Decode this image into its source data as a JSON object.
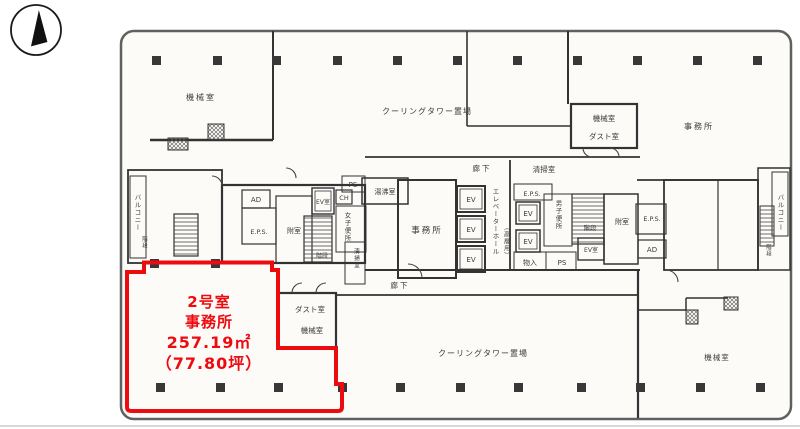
{
  "highlight": {
    "room_no": "2号室",
    "use": "事務所",
    "area_sqm": "257.19㎡",
    "area_tsubo": "（77.80坪）",
    "outline_color": "#ee0b10"
  },
  "rooms": {
    "machine_room_top_left": "機械室",
    "cooling_tower_top": "クーリングタワー置場",
    "machine_room_top_right": "機械室",
    "dust_room_top_right": "ダスト室",
    "office_top_right": "事務所",
    "balcony_left": "バルコニー",
    "stairs_balcony_left": "階段",
    "ad_left": "AD",
    "eps_left": "E.P.S.",
    "anteroom_left": "附室",
    "ev_room_left": "EV室",
    "ch_duct": "CH",
    "ps_left": "PS",
    "hot_water_room": "湯沸室",
    "womens_toilet": "女子便所",
    "stairs_center": "階段",
    "cleaning_room_small": "清掃室",
    "office_center": "事務所",
    "corridor_top": "廊下",
    "elevator": "EV",
    "elevator_hall": "エレベーターホール",
    "high_rise": "（高層用）",
    "cleaning_room_right": "清掃室",
    "eps_center": "E.P.S.",
    "mens_toilet": "男子便所",
    "stairs_right": "階段",
    "ev_room_right": "EV室",
    "storage": "物入",
    "ps_right": "PS",
    "anteroom_right": "附室",
    "eps_right": "E.P.S.",
    "ad_right": "AD",
    "corridor_bottom": "廊下",
    "balcony_right": "バルコニー",
    "stairs_balcony_right": "階段",
    "dust_room_notch": "ダスト室",
    "machine_room_notch": "機械室",
    "cooling_tower_bottom": "クーリングタワー置場",
    "machine_room_bottom_right": "機械室"
  },
  "colors": {
    "wall": "#333333",
    "column": "#383838",
    "highlight": "#ee0b10"
  }
}
